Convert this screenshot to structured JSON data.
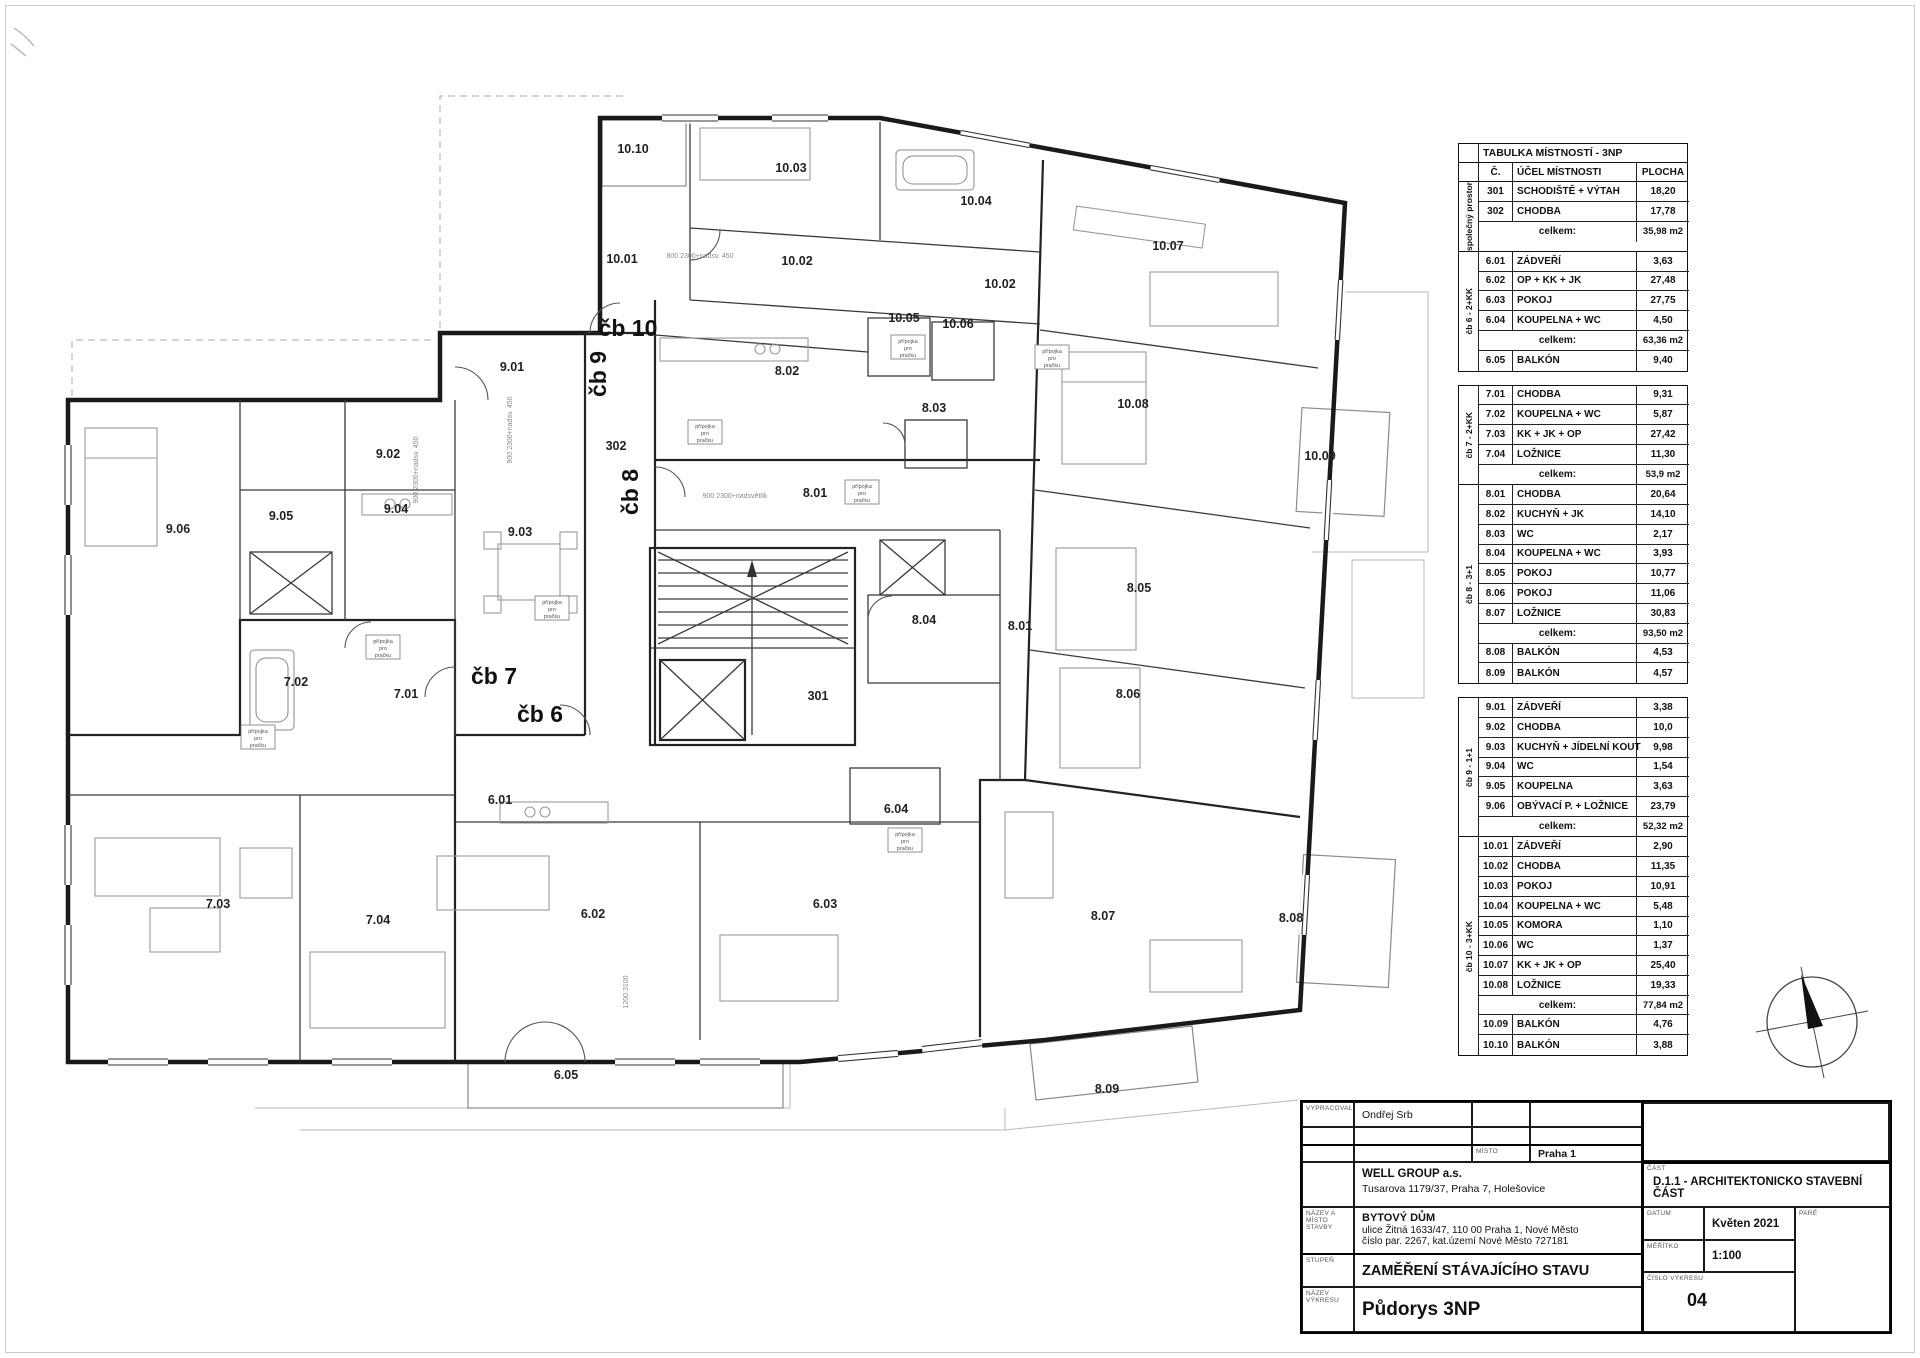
{
  "plan": {
    "room_labels": [
      {
        "t": "10.10",
        "x": 633,
        "y": 153
      },
      {
        "t": "10.03",
        "x": 791,
        "y": 172
      },
      {
        "t": "10.04",
        "x": 976,
        "y": 205
      },
      {
        "t": "10.07",
        "x": 1168,
        "y": 250
      },
      {
        "t": "10.01",
        "x": 622,
        "y": 263
      },
      {
        "t": "10.02",
        "x": 797,
        "y": 265
      },
      {
        "t": "10.02",
        "x": 1000,
        "y": 288
      },
      {
        "t": "10.05",
        "x": 904,
        "y": 322
      },
      {
        "t": "10.06",
        "x": 958,
        "y": 328
      },
      {
        "t": "10.08",
        "x": 1133,
        "y": 408
      },
      {
        "t": "10.09",
        "x": 1320,
        "y": 460
      },
      {
        "t": "9.01",
        "x": 512,
        "y": 371
      },
      {
        "t": "9.02",
        "x": 388,
        "y": 458
      },
      {
        "t": "302",
        "x": 616,
        "y": 450
      },
      {
        "t": "8.02",
        "x": 787,
        "y": 375
      },
      {
        "t": "8.03",
        "x": 934,
        "y": 412
      },
      {
        "t": "8.01",
        "x": 815,
        "y": 497
      },
      {
        "t": "9.06",
        "x": 178,
        "y": 533
      },
      {
        "t": "9.05",
        "x": 281,
        "y": 520
      },
      {
        "t": "9.04",
        "x": 396,
        "y": 513
      },
      {
        "t": "9.03",
        "x": 520,
        "y": 536
      },
      {
        "t": "8.05",
        "x": 1139,
        "y": 592
      },
      {
        "t": "8.04",
        "x": 924,
        "y": 624
      },
      {
        "t": "8.01",
        "x": 1020,
        "y": 630
      },
      {
        "t": "7.02",
        "x": 296,
        "y": 686
      },
      {
        "t": "7.01",
        "x": 406,
        "y": 698
      },
      {
        "t": "301",
        "x": 818,
        "y": 700
      },
      {
        "t": "8.06",
        "x": 1128,
        "y": 698
      },
      {
        "t": "6.01",
        "x": 500,
        "y": 804
      },
      {
        "t": "6.04",
        "x": 896,
        "y": 813
      },
      {
        "t": "7.03",
        "x": 218,
        "y": 908
      },
      {
        "t": "7.04",
        "x": 378,
        "y": 924
      },
      {
        "t": "6.02",
        "x": 593,
        "y": 918
      },
      {
        "t": "6.03",
        "x": 825,
        "y": 908
      },
      {
        "t": "8.07",
        "x": 1103,
        "y": 920
      },
      {
        "t": "8.08",
        "x": 1291,
        "y": 922
      },
      {
        "t": "6.05",
        "x": 566,
        "y": 1079
      },
      {
        "t": "8.09",
        "x": 1107,
        "y": 1093
      }
    ],
    "unit_labels": [
      {
        "t": "čb 10",
        "x": 628,
        "y": 336,
        "rot": 0
      },
      {
        "t": "čb 9",
        "x": 606,
        "y": 374,
        "rot": -90
      },
      {
        "t": "čb 8",
        "x": 638,
        "y": 492,
        "rot": -90
      },
      {
        "t": "čb 7",
        "x": 494,
        "y": 684,
        "rot": 0
      },
      {
        "t": "čb 6",
        "x": 540,
        "y": 722,
        "rot": 0
      }
    ],
    "dim_notes": [
      {
        "t": "900  2300+nadsv. 450",
        "x": 512,
        "y": 430,
        "rot": -90
      },
      {
        "t": "900  2300+nadsvětlík",
        "x": 735,
        "y": 498,
        "rot": 0
      },
      {
        "t": "800  2300+nadsv. 450",
        "x": 700,
        "y": 258,
        "rot": 0
      },
      {
        "t": "900  2300+nadsv. 450",
        "x": 418,
        "y": 470,
        "rot": -90
      },
      {
        "t": "1200  3100",
        "x": 628,
        "y": 992,
        "rot": -90
      }
    ],
    "fixture_note_lines": [
      "přípojka",
      "pro",
      "pračku"
    ],
    "fixture_note_positions": [
      [
        552,
        608
      ],
      [
        383,
        647
      ],
      [
        258,
        737
      ],
      [
        705,
        432
      ],
      [
        862,
        492
      ],
      [
        908,
        347
      ],
      [
        1052,
        357
      ],
      [
        905,
        840
      ]
    ],
    "compass_icon": "north-arrow-compass"
  },
  "room_table": {
    "title": "TABULKA MÍSTNOSTÍ - 3NP",
    "columns": [
      "Č.",
      "ÚČEL MÍSTNOSTI",
      "PLOCHA"
    ],
    "subtotal_label": "celkem:",
    "groups": [
      {
        "group": "společný prostor",
        "gap": false,
        "rows": [
          [
            "301",
            "SCHODIŠTĚ + VÝTAH",
            "18,20"
          ],
          [
            "302",
            "CHODBA",
            "17,78"
          ]
        ],
        "subtotal": "35,98 m2",
        "after": []
      },
      {
        "group": "čb 6 - 2+KK",
        "gap": false,
        "rows": [
          [
            "6.01",
            "ZÁDVEŘÍ",
            "3,63"
          ],
          [
            "6.02",
            "OP + KK + JK",
            "27,48"
          ],
          [
            "6.03",
            "POKOJ",
            "27,75"
          ],
          [
            "6.04",
            "KOUPELNA + WC",
            "4,50"
          ]
        ],
        "subtotal": "63,36 m2",
        "after": [
          [
            "6.05",
            "BALKÓN",
            "9,40"
          ]
        ]
      },
      {
        "group": "čb 7 - 2+KK",
        "gap": true,
        "rows": [
          [
            "7.01",
            "CHODBA",
            "9,31"
          ],
          [
            "7.02",
            "KOUPELNA + WC",
            "5,87"
          ],
          [
            "7.03",
            "KK + JK + OP",
            "27,42"
          ],
          [
            "7.04",
            "LOŽNICE",
            "11,30"
          ]
        ],
        "subtotal": "53,9 m2",
        "after": []
      },
      {
        "group": "čb 8 - 3+1",
        "gap": false,
        "rows": [
          [
            "8.01",
            "CHODBA",
            "20,64"
          ],
          [
            "8.02",
            "KUCHYŇ + JK",
            "14,10"
          ],
          [
            "8.03",
            "WC",
            "2,17"
          ],
          [
            "8.04",
            "KOUPELNA + WC",
            "3,93"
          ],
          [
            "8.05",
            "POKOJ",
            "10,77"
          ],
          [
            "8.06",
            "POKOJ",
            "11,06"
          ],
          [
            "8.07",
            "LOŽNICE",
            "30,83"
          ]
        ],
        "subtotal": "93,50 m2",
        "after": [
          [
            "8.08",
            "BALKÓN",
            "4,53"
          ],
          [
            "8.09",
            "BALKÓN",
            "4,57"
          ]
        ]
      },
      {
        "group": "čb 9 - 1+1",
        "gap": true,
        "rows": [
          [
            "9.01",
            "ZÁDVEŘÍ",
            "3,38"
          ],
          [
            "9.02",
            "CHODBA",
            "10,0"
          ],
          [
            "9.03",
            "KUCHYŇ + JÍDELNÍ KOUT",
            "9,98"
          ],
          [
            "9.04",
            "WC",
            "1,54"
          ],
          [
            "9.05",
            "KOUPELNA",
            "3,63"
          ],
          [
            "9.06",
            "OBÝVACÍ P. + LOŽNICE",
            "23,79"
          ]
        ],
        "subtotal": "52,32 m2",
        "after": []
      },
      {
        "group": "čb 10 - 3+KK",
        "gap": false,
        "rows": [
          [
            "10.01",
            "ZÁDVEŘÍ",
            "2,90"
          ],
          [
            "10.02",
            "CHODBA",
            "11,35"
          ],
          [
            "10.03",
            "POKOJ",
            "10,91"
          ],
          [
            "10.04",
            "KOUPELNA + WC",
            "5,48"
          ],
          [
            "10.05",
            "KOMORA",
            "1,10"
          ],
          [
            "10.06",
            "WC",
            "1,37"
          ],
          [
            "10.07",
            "KK + JK + OP",
            "25,40"
          ],
          [
            "10.08",
            "LOŽNICE",
            "19,33"
          ]
        ],
        "subtotal": "77,84 m2",
        "after": [
          [
            "10.09",
            "BALKÓN",
            "4,76"
          ],
          [
            "10.10",
            "BALKÓN",
            "3,88"
          ]
        ]
      }
    ]
  },
  "tb": {
    "vypracoval_label": "VYPRACOVAL",
    "vypracoval": "Ondřej Srb",
    "misto_label": "MÍSTO",
    "misto": "Praha 1",
    "investor_name": "WELL GROUP a.s.",
    "investor_address": "Tusarova 1179/37, Praha 7, Holešovice",
    "stavba_label": "NÁZEV A MÍSTO STAVBY",
    "stavba_name": "BYTOVÝ DŮM",
    "stavba_address1": "ulice Žitná 1633/47, 110 00  Praha 1, Nové Město",
    "stavba_address2": "číslo par. 2267, kat.území Nové Město 727181",
    "stupen_label": "STUPEŇ",
    "stupen": "ZAMĚŘENÍ STÁVAJÍCÍHO STAVU",
    "vykres_label": "NÁZEV VÝKRESU",
    "vykres": "Půdorys 3NP",
    "cast_label": "ČÁST",
    "cast": "D.1.1 - ARCHITEKTONICKO STAVEBNÍ ČÁST",
    "datum_label": "DATUM",
    "datum": "Květen 2021",
    "pare_label": "PARÉ",
    "meritko_label": "MĚŘÍTKO",
    "meritko": "1:100",
    "cislo_label": "ČÍSLO VÝKRESU",
    "cislo": "04"
  }
}
